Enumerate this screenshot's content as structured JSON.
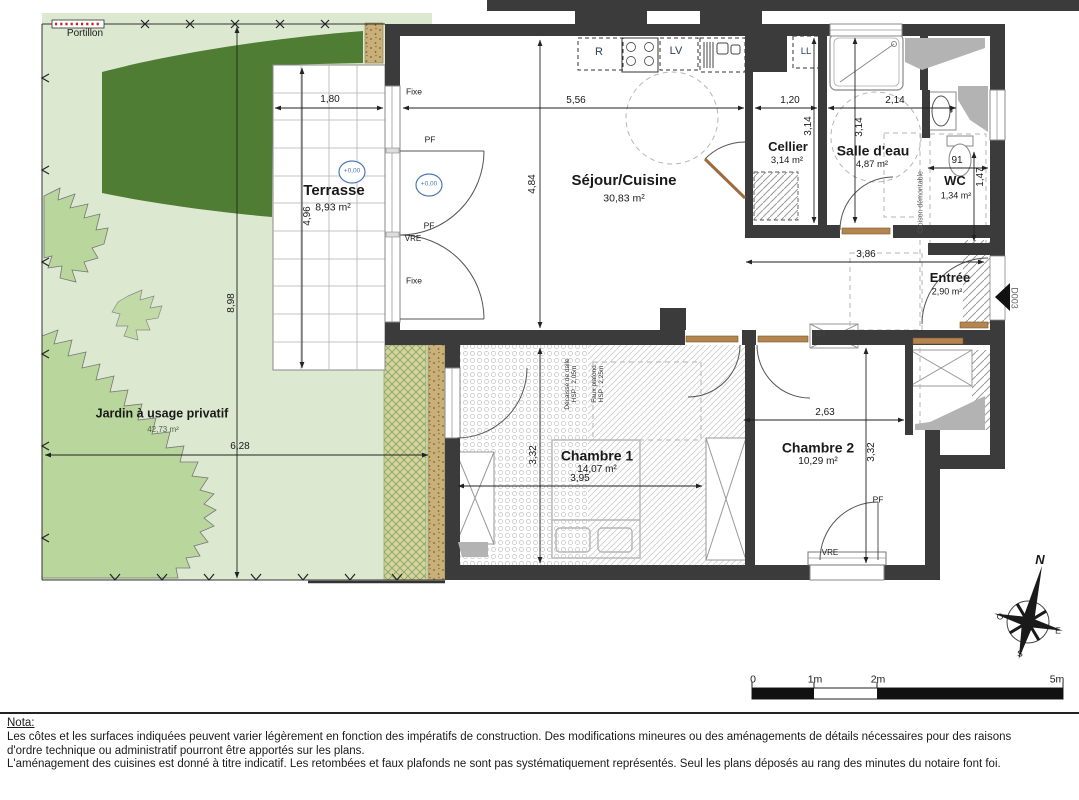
{
  "plan": {
    "garden": {
      "label": "Jardin à usage privatif",
      "area": "42,73 m²",
      "portillon": "Portillon",
      "dim_height": "8,98",
      "dim_width": "6,28"
    },
    "terrasse": {
      "name": "Terrasse",
      "area": "8,93 m²",
      "dim_width": "1,80",
      "dim_height": "4,96",
      "level": "+0,00"
    },
    "sejour": {
      "name": "Séjour/Cuisine",
      "area": "30,83 m²",
      "dim_width": "5,56",
      "dim_height": "4,84"
    },
    "cellier": {
      "name": "Cellier",
      "area": "3,14 m²",
      "dim_width": "1,20",
      "dim_height": "3,14"
    },
    "salle_eau": {
      "name": "Salle d'eau",
      "area": "4,87 m²",
      "dim_width": "2,14",
      "dim_height": "3,14",
      "cloison": "Cloison démontable"
    },
    "wc": {
      "name": "WC",
      "area": "1,34 m²",
      "dim_width": "91",
      "dim_height": "1,47"
    },
    "entree": {
      "name": "Entrée",
      "area": "2,90 m²",
      "dim_width": "3,86",
      "door_code": "D003",
      "gt": "GT"
    },
    "chambre1": {
      "name": "Chambre 1",
      "area": "14,07 m²",
      "dim_width": "3,95",
      "dim_height": "3,32",
      "note1_l1": "Décaissé de dalle",
      "note1_l2": "HSP : 2,05m",
      "note2_l1": "Faux plafond",
      "note2_l2": "HSP : 2,25m"
    },
    "chambre2": {
      "name": "Chambre 2",
      "area": "10,29 m²",
      "dim_width": "2,63",
      "dim_height": "3,32"
    },
    "openings": {
      "fixe": "Fixe",
      "pf": "PF",
      "vre": "VRE"
    },
    "kitchen": {
      "fridge": "R",
      "dishwasher": "LV",
      "washer": "LL"
    },
    "compass": {
      "north": "N",
      "south": "S",
      "east": "E",
      "west": "O"
    },
    "scale_bar": {
      "zero": "0",
      "one": "1m",
      "two": "2m",
      "five": "5m"
    },
    "colors": {
      "wall": "#3b3b3b",
      "garden": "#dce8d0",
      "hedge": "#4f7d33",
      "bush": "#b9d79c",
      "level_blue": "#4a7ab5",
      "wood": "#9c6b3f"
    }
  },
  "nota": {
    "title": "Nota:",
    "line1": "Les côtes et les surfaces indiquées peuvent varier légèrement en fonction des impératifs de construction. Des modifications mineures ou des aménagements de détails nécessaires pour des raisons",
    "line2": "d'ordre technique ou administratif pourront être apportés sur les plans.",
    "line3": "L'aménagement des cuisines est donné à titre indicatif. Les retombées et faux plafonds ne sont pas systématiquement représentés. Seul les plans déposés au rang des minutes du notaire font foi."
  }
}
